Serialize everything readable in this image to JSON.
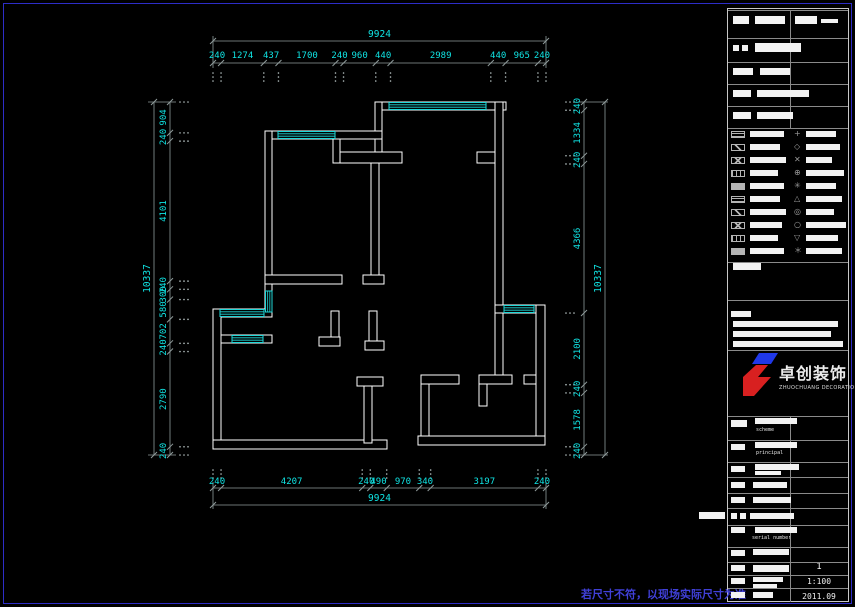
{
  "colors": {
    "background": "#000000",
    "wall": "#ffffff",
    "window": "#1fd9d9",
    "dimension_text": "#10e4e4",
    "dimension_line": "#8f9b9b",
    "sheet_frame": "#2d2dc8",
    "disclaimer_text": "#4040d8",
    "logo_red": "#d82020",
    "logo_blue": "#2038e8"
  },
  "dimensions": {
    "top": {
      "overall": "9924",
      "segments": [
        "240",
        "1274",
        "437",
        "1700",
        "240",
        "960",
        "440",
        "2989",
        "440",
        "965",
        "240"
      ]
    },
    "bottom": {
      "overall": "9924",
      "segments": [
        "240",
        "4207",
        "240",
        "490",
        "970",
        "340",
        "3197",
        "240"
      ]
    },
    "left": {
      "overall": "10337",
      "segments": [
        "904",
        "240",
        "4101",
        "240",
        "300",
        "580",
        "702",
        "240",
        "2790",
        "240"
      ]
    },
    "right": {
      "overall": "10337",
      "segments": [
        "240",
        "1334",
        "240",
        "4366",
        "2100",
        "240",
        "1578",
        "240"
      ]
    }
  },
  "title_block": {
    "scheme_label": "scheme",
    "principal_label": "principal",
    "serial_label": "serial number",
    "sheet_no": "1",
    "scale": "1:100",
    "date": "2011.09"
  },
  "logo": {
    "name_cn": "卓创装饰",
    "name_en": "ZHUOCHUANG DECORATION"
  },
  "sheet": {
    "disclaimer": "若尺寸不符，以现场实际尺寸为准"
  }
}
